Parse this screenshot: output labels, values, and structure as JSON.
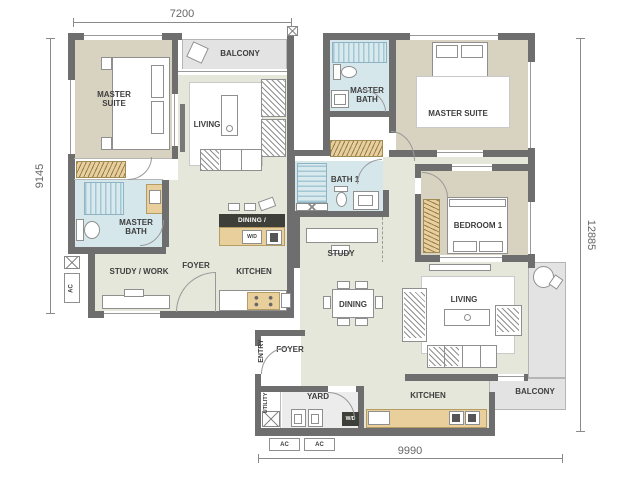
{
  "dimensions": {
    "top": "7200",
    "left": "9145",
    "right": "12885",
    "bottom": "9990"
  },
  "unit_a": {
    "master_suite": "MASTER SUITE",
    "balcony": "BALCONY",
    "living": "LIVING",
    "master_bath": "MASTER BATH",
    "study_work": "STUDY / WORK",
    "foyer": "FOYER",
    "kitchen": "KITCHEN",
    "dining_breakfast": "DINING / BREAKFAST",
    "wd": "W/D",
    "ac": "AC"
  },
  "unit_b": {
    "master_bath": "MASTER BATH",
    "master_suite": "MASTER SUITE",
    "bath1": "BATH 1",
    "bedroom1": "BEDROOM 1",
    "study": "STUDY",
    "dining": "DINING",
    "living": "LIVING",
    "foyer": "FOYER",
    "entry": "ENTRY",
    "utility": "UTILITY",
    "yard": "YARD",
    "kitchen": "KITCHEN",
    "balcony": "BALCONY",
    "wd": "W/D",
    "ac_1": "AC",
    "ac_2": "AC"
  },
  "colors": {
    "wall": "#6e6e6e",
    "bedroom_floor": "#d8d2c0",
    "common_floor": "#e4e7da",
    "bath_floor": "#d6e7ec",
    "bath_stripe": "#a4c7d5",
    "wardrobe": "#e9cf9c",
    "balcony_floor": "#e3e3e3",
    "label_box": "#3f3f39",
    "text": "#3e3e3e"
  }
}
